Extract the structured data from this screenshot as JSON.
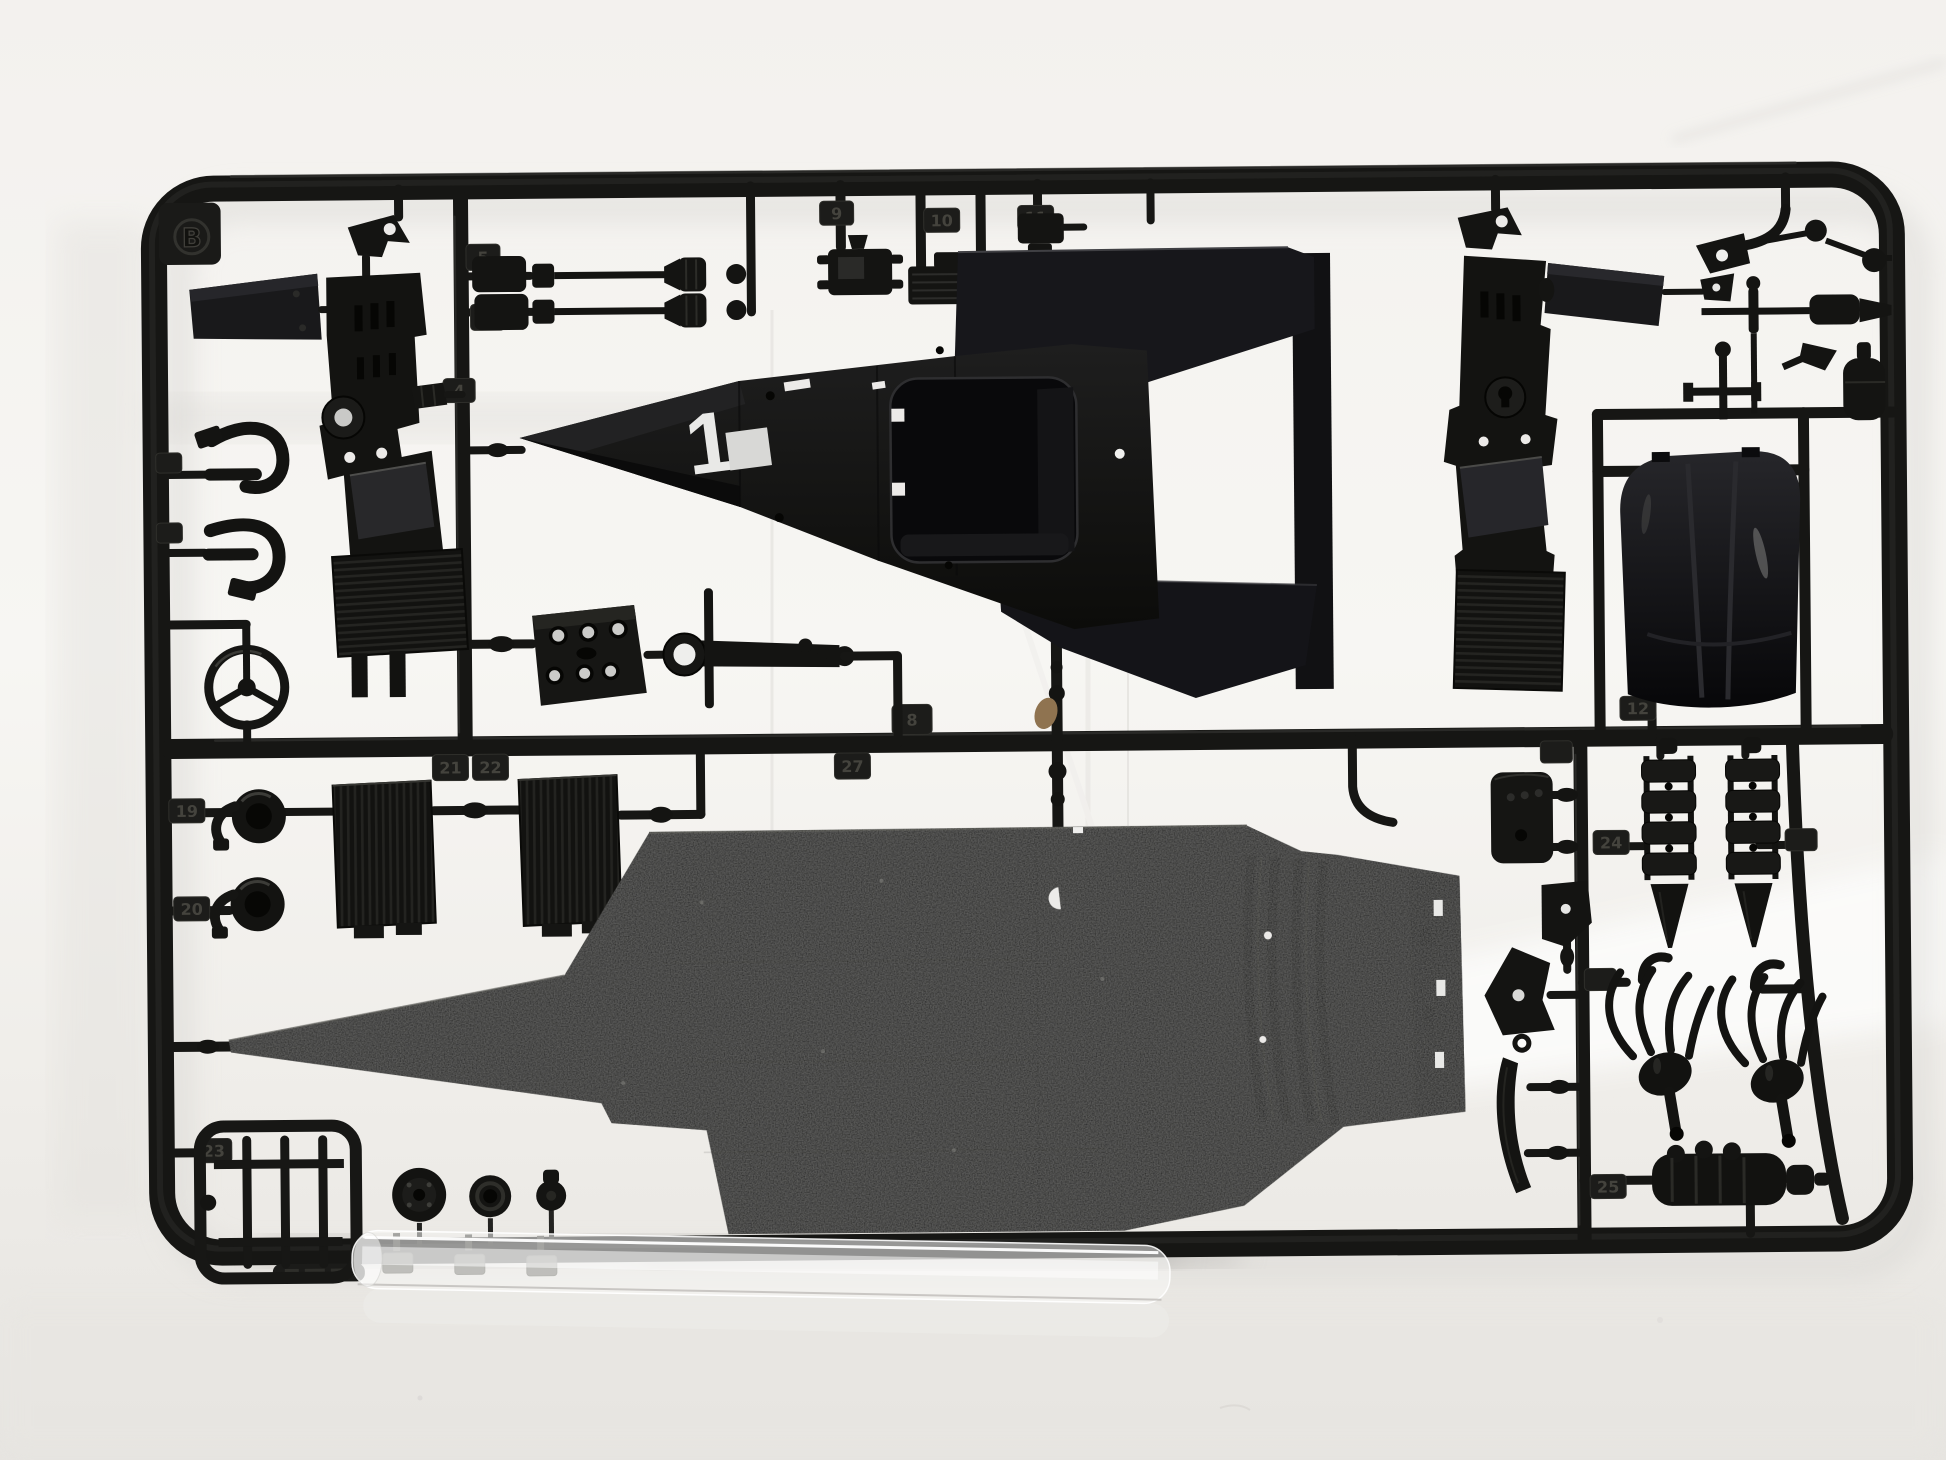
{
  "scene": {
    "description": "Photograph of an unassembled black plastic model-kit parts sprue (runner B) of a Formula One car kit: body cowl, floor pan with diffuser, bucket seat, radiators, drive shafts, steering wheel, hoses and exhaust parts, shot on a white background with a clear plastic strip lying in front of the bottom rail.",
    "runner_letter": "B",
    "body_decal_number": "1"
  },
  "markings": {
    "runner_letter": "B",
    "body_number": "1",
    "gate_numbers": {
      "n4": "4",
      "n5": "5",
      "n6": "6",
      "n8": "8",
      "n9": "9",
      "n10": "10",
      "n11": "11",
      "n12": "12",
      "n19": "19",
      "n20": "20",
      "n21": "21",
      "n22": "22",
      "n23": "23",
      "n24": "24",
      "n25": "25",
      "n27": "27"
    }
  },
  "parts_visible": [
    "runner frame",
    "wing endplate",
    "sidepod assembly left",
    "sidepod assembly right",
    "drive shafts",
    "steering wheel",
    "coolant hoses",
    "radiator grilles",
    "engine block",
    "suspension rocker",
    "body cowl with cockpit opening",
    "bucket seat",
    "floor pan with rear diffuser",
    "air trumpets",
    "tubular frame",
    "pulleys",
    "coil stacks",
    "exhaust manifolds",
    "finned cylinder",
    "clear plastic strip"
  ],
  "palette": {
    "background": "#f2f0ed",
    "bright_band": "#fcfcfb",
    "table": "#e7e5e1",
    "plastic_dark": "#141412",
    "plastic_highlight": "#3b3b37",
    "floor_matte": "#1d1d1b",
    "gloss_black": "#0c0c0e",
    "white_marking": "#e9e9e7",
    "clear_strip": "rgba(250,250,248,0.55)",
    "debris_tan": "#8f7350"
  }
}
